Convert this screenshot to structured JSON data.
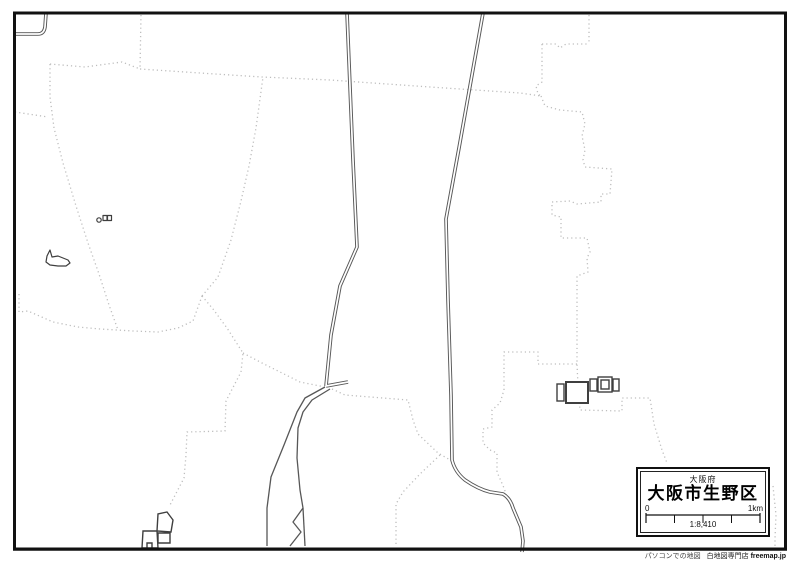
{
  "map": {
    "prefecture_label": "大阪府",
    "title": "大阪市生野区",
    "scale": {
      "left_label": "0",
      "right_label": "1km",
      "ratio": "1:8,410"
    },
    "credit": {
      "tagline": "パソコンでの地図",
      "shop": "白地図専門店",
      "brand": "freemap.jp"
    }
  },
  "colors": {
    "frame": "#111111",
    "river_line": "#575757",
    "boundary_dotted": "#bdbdbd",
    "background": "#ffffff"
  }
}
